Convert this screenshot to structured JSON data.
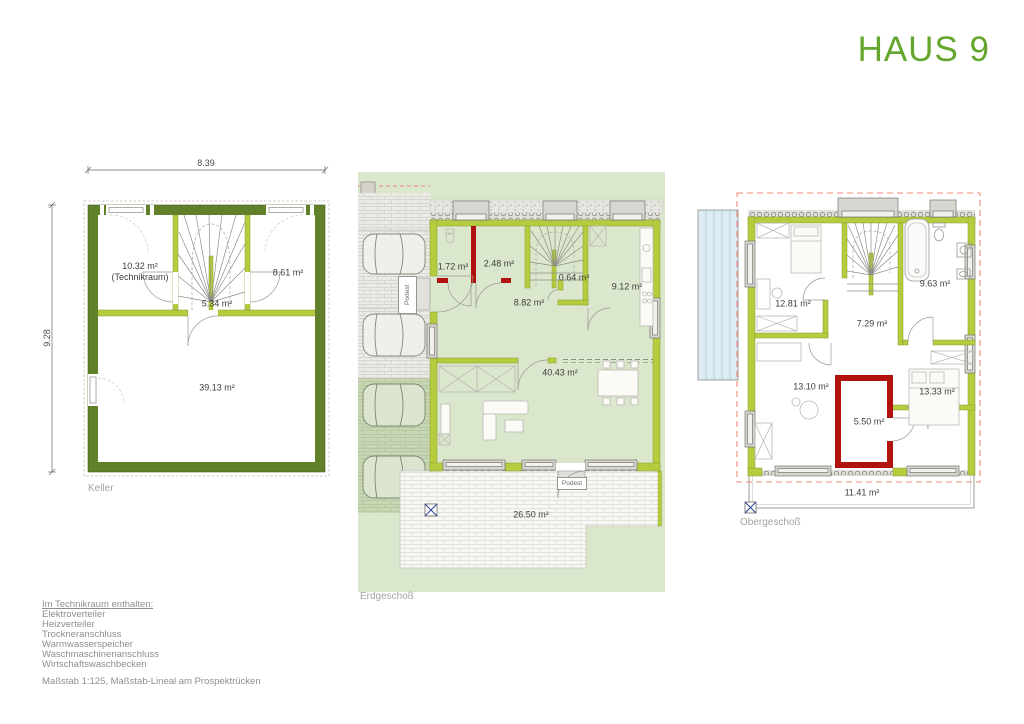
{
  "title": "HAUS 9",
  "colors": {
    "accent_green": "#64a62e",
    "wall_green": "#b5cc3e",
    "wall_dark_green": "#61802a",
    "wall_red": "#b2120e",
    "roof_outline_red": "#f08a78"
  },
  "keller": {
    "label": "Keller",
    "dim_width": "8.39",
    "dim_height": "9.28",
    "rooms": {
      "technik_area": "10.32 m²",
      "technik_name": "(Technikraum)",
      "kellerraum": "8.61 m²",
      "flur": "5.34 m²",
      "hauptraum": "39.13 m²"
    }
  },
  "erdgeschoss": {
    "label": "Erdgeschoß",
    "rooms": {
      "wc": "1.72 m²",
      "windfang": "2.48 m²",
      "abstellraum": "0.64 m²",
      "flur": "8.82 m²",
      "kueche": "9.12 m²",
      "wohnen_essen": "40.43 m²",
      "terrasse": "26.50 m²"
    },
    "podest_entry": "Podest",
    "podest_terrace": "Podest"
  },
  "obergeschoss": {
    "label": "Obergeschoß",
    "rooms": {
      "zimmer_links": "12.81 m²",
      "bad": "9.63 m²",
      "flur": "7.29 m²",
      "zimmer_unten_links": "13.10 m²",
      "zimmer_unten_rechts": "13.33 m²",
      "ankleide": "5.50 m²",
      "balkon": "11.41 m²"
    }
  },
  "legend": {
    "heading": "Im Technikraum enthalten:",
    "items": [
      "Elektroverteiler",
      "Heizverteiler",
      "Trockneranschluss",
      "Warmwasserspeicher",
      "Waschmaschinenanschluss",
      "Wirtschaftswaschbecken"
    ],
    "scale_note": "Maßstab 1:125, Maßstab-Lineal am Prospektrücken"
  }
}
